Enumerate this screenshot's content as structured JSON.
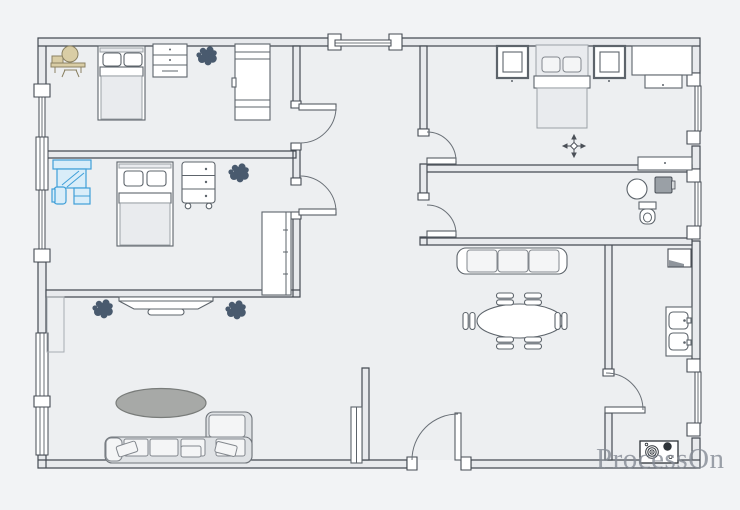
{
  "app": {
    "watermark": "ProcessOn"
  },
  "colors": {
    "canvas_bg": "#f2f3f5",
    "floor": "#edeff1",
    "wall_fill": "#e8eaed",
    "wall_stroke": "#454b53",
    "furn_stroke": "#5d646b",
    "soft_fill": "#e9ebee",
    "cushion_fill": "#f4f5f6",
    "sofa_fill": "#dfe2e5",
    "accent_blue": "#3f9fd8",
    "accent_blue_fill": "#d9edf9",
    "plant_dark": "#3c4e63",
    "rug_gray": "#a7a9a7",
    "rug_stroke": "#797c7a",
    "vanity_tan": "#d9cda5",
    "vanity_stroke": "#8a8162",
    "appliance_gray": "#9aa0a6",
    "burner_dark": "#2e3338",
    "watermark_gray": "#858b95"
  },
  "furniture": {
    "bedroom_top_left": [
      "dressing-table",
      "single-bed",
      "dresser",
      "plant",
      "wardrobe"
    ],
    "bedroom_mid_left": [
      "computer-desk",
      "single-bed",
      "drawer-cart",
      "plant",
      "wardrobe"
    ],
    "bedroom_top_right": [
      "nightstand",
      "double-bed",
      "nightstand",
      "desk",
      "bench",
      "ceiling-fan",
      "sideboard"
    ],
    "bathroom": [
      "basin",
      "washing-machine",
      "toilet"
    ],
    "living_room": [
      "tv-stand",
      "plant",
      "plant",
      "rug",
      "sectional-sofa",
      "shoe-cabinet"
    ],
    "dining_area": [
      "bench-sofa",
      "oval-table",
      "dining-chairs-x6",
      "wall-cabinet",
      "double-sink"
    ],
    "kitchen": [
      "cooktop"
    ]
  }
}
